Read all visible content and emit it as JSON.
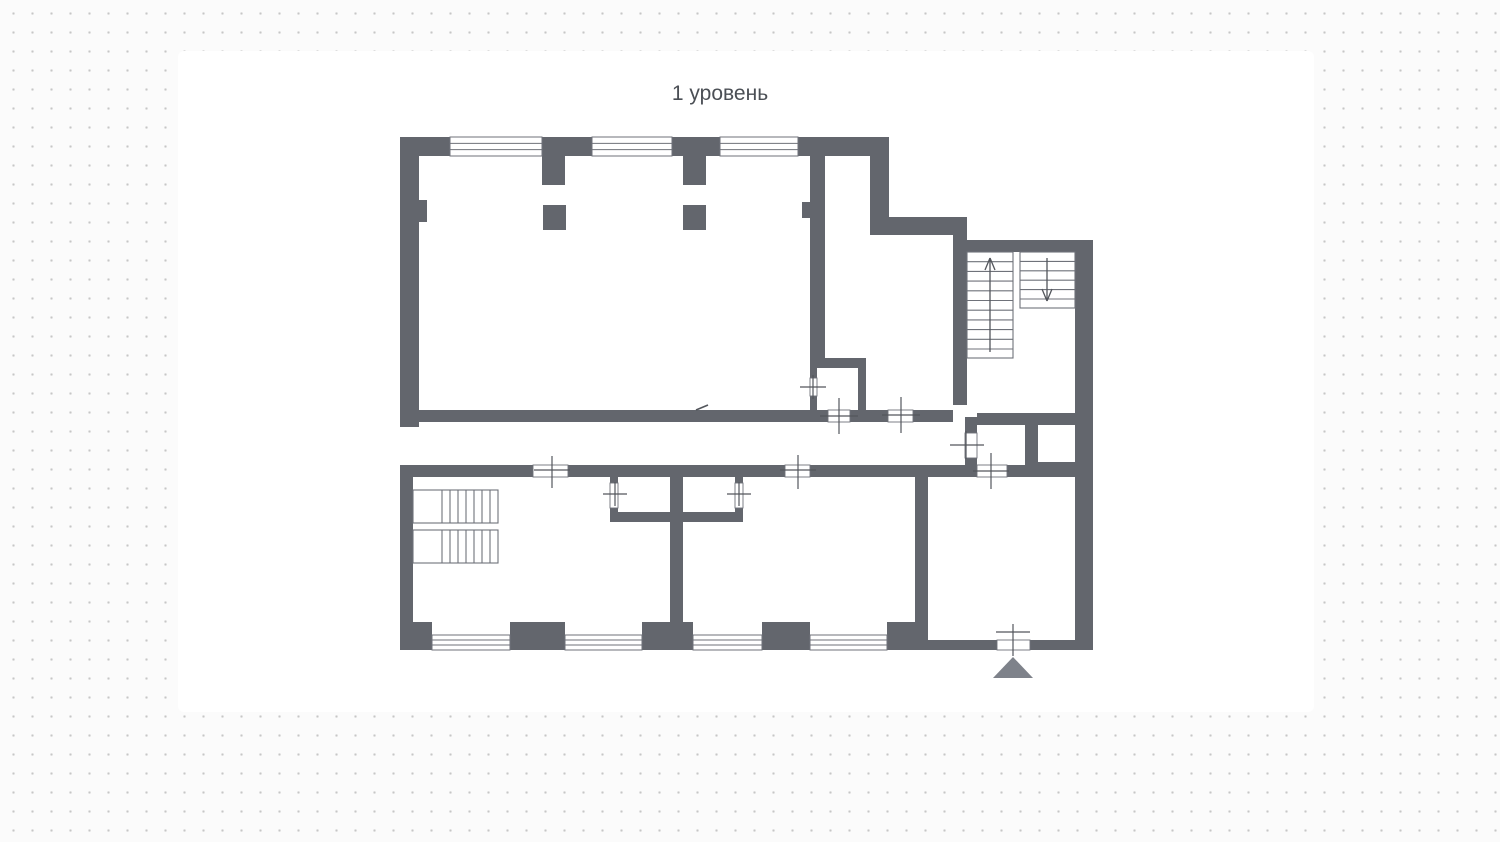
{
  "title": "1 уровень",
  "canvas": {
    "background": "#fbfbfb",
    "dot_color": "#c6c6c6",
    "sheet_color": "#ffffff",
    "title_color": "#4b4f55"
  },
  "plan": {
    "colors": {
      "wall": "#63666d",
      "line": "#6f727a",
      "cross": "#53565c",
      "triangle": "#7e828a"
    },
    "walls": [
      [
        400,
        137,
        50,
        19
      ],
      [
        542,
        137,
        50,
        19
      ],
      [
        672,
        137,
        48,
        19
      ],
      [
        798,
        137,
        91,
        19
      ],
      [
        400,
        137,
        19,
        290
      ],
      [
        419,
        200,
        8,
        22
      ],
      [
        542,
        156,
        23,
        29
      ],
      [
        683,
        156,
        23,
        29
      ],
      [
        543,
        205,
        23,
        25
      ],
      [
        683,
        205,
        23,
        25
      ],
      [
        810,
        156,
        15,
        204
      ],
      [
        802,
        202,
        8,
        16
      ],
      [
        870,
        156,
        19,
        79
      ],
      [
        870,
        217,
        97,
        18
      ],
      [
        953,
        235,
        14,
        170
      ],
      [
        955,
        240,
        138,
        12
      ],
      [
        1075,
        240,
        18,
        410
      ],
      [
        977,
        413,
        98,
        12
      ],
      [
        965,
        417,
        12,
        16
      ],
      [
        965,
        458,
        12,
        19
      ],
      [
        1025,
        425,
        13,
        52
      ],
      [
        1025,
        462,
        50,
        15
      ],
      [
        810,
        358,
        56,
        10
      ],
      [
        810,
        368,
        7,
        10
      ],
      [
        810,
        396,
        7,
        16
      ],
      [
        858,
        358,
        8,
        54
      ],
      [
        400,
        410,
        428,
        12
      ],
      [
        850,
        410,
        38,
        12
      ],
      [
        913,
        410,
        40,
        12
      ],
      [
        400,
        465,
        133,
        12
      ],
      [
        568,
        465,
        217,
        12
      ],
      [
        810,
        465,
        167,
        12
      ],
      [
        1007,
        465,
        83,
        12
      ],
      [
        400,
        465,
        13,
        185
      ],
      [
        670,
        477,
        13,
        145
      ],
      [
        610,
        512,
        133,
        10
      ],
      [
        610,
        477,
        8,
        6
      ],
      [
        610,
        508,
        8,
        5
      ],
      [
        735,
        477,
        8,
        6
      ],
      [
        735,
        508,
        8,
        5
      ],
      [
        915,
        477,
        13,
        145
      ],
      [
        400,
        622,
        32,
        28
      ],
      [
        510,
        622,
        55,
        28
      ],
      [
        642,
        622,
        51,
        28
      ],
      [
        762,
        622,
        48,
        28
      ],
      [
        887,
        622,
        41,
        28
      ],
      [
        928,
        640,
        69,
        10
      ],
      [
        1030,
        640,
        63,
        10
      ]
    ],
    "windows": [
      [
        450,
        137,
        92,
        19
      ],
      [
        592,
        137,
        80,
        19
      ],
      [
        720,
        137,
        78,
        19
      ],
      [
        432,
        635,
        78,
        15
      ],
      [
        565,
        635,
        77,
        15
      ],
      [
        693,
        635,
        69,
        15
      ],
      [
        810,
        635,
        77,
        15
      ]
    ],
    "door_gaps": [
      [
        828,
        410,
        22,
        12
      ],
      [
        888,
        410,
        25,
        12
      ],
      [
        533,
        465,
        35,
        12
      ],
      [
        785,
        465,
        25,
        12
      ],
      [
        977,
        465,
        30,
        12
      ],
      [
        997,
        640,
        33,
        10
      ],
      [
        810,
        378,
        7,
        18
      ],
      [
        610,
        483,
        8,
        25
      ],
      [
        735,
        483,
        8,
        25
      ],
      [
        965,
        433,
        12,
        25
      ]
    ],
    "crosses": [
      {
        "h": [
          820,
          416,
          858,
          416
        ],
        "v": [
          839,
          398,
          839,
          434
        ]
      },
      {
        "h": [
          882,
          415,
          920,
          415
        ],
        "v": [
          901,
          397,
          901,
          433
        ]
      },
      {
        "h": [
          534,
          470,
          570,
          470
        ],
        "v": [
          552,
          456,
          552,
          488
        ]
      },
      {
        "h": [
          780,
          470,
          816,
          470
        ],
        "v": [
          798,
          455,
          798,
          489
        ]
      },
      {
        "h": [
          973,
          471,
          1009,
          471
        ],
        "v": [
          991,
          453,
          991,
          489
        ]
      },
      {
        "h": [
          800,
          387,
          826,
          387
        ],
        "v": [
          813,
          375,
          813,
          399
        ]
      },
      {
        "h": [
          603,
          494,
          627,
          494
        ],
        "v": [
          615,
          482,
          615,
          506
        ]
      },
      {
        "h": [
          727,
          494,
          751,
          494
        ],
        "v": [
          739,
          482,
          739,
          506
        ]
      },
      {
        "h": [
          950,
          445,
          984,
          445
        ],
        "v": [
          966,
          431,
          966,
          459
        ]
      },
      {
        "h": [
          996,
          632,
          1030,
          632
        ],
        "v": [
          1013,
          624,
          1013,
          656
        ]
      }
    ],
    "stairs": [
      {
        "box": [
          413,
          490,
          85,
          33
        ],
        "treads": "v",
        "from": 442,
        "step": 8,
        "count": 7
      },
      {
        "box": [
          413,
          530,
          85,
          33
        ],
        "treads": "v",
        "from": 442,
        "step": 8,
        "count": 7
      },
      {
        "box": [
          967,
          252,
          46,
          106
        ],
        "treads": "h",
        "from": 261.7,
        "step": 9.7,
        "count": 10,
        "arrow": {
          "x": 990,
          "from": 352,
          "to": 258,
          "dir": "up"
        }
      },
      {
        "box": [
          1020,
          252,
          55,
          56
        ],
        "treads": "h",
        "from": 261.4,
        "step": 9.4,
        "count": 5,
        "arrow": {
          "x": 1047,
          "from": 258,
          "to": 301,
          "dir": "down"
        }
      }
    ],
    "entrance_triangle": [
      [
        993,
        678
      ],
      [
        1033,
        678
      ],
      [
        1013,
        657
      ]
    ],
    "mark": [
      696,
      410,
      708,
      405
    ]
  }
}
